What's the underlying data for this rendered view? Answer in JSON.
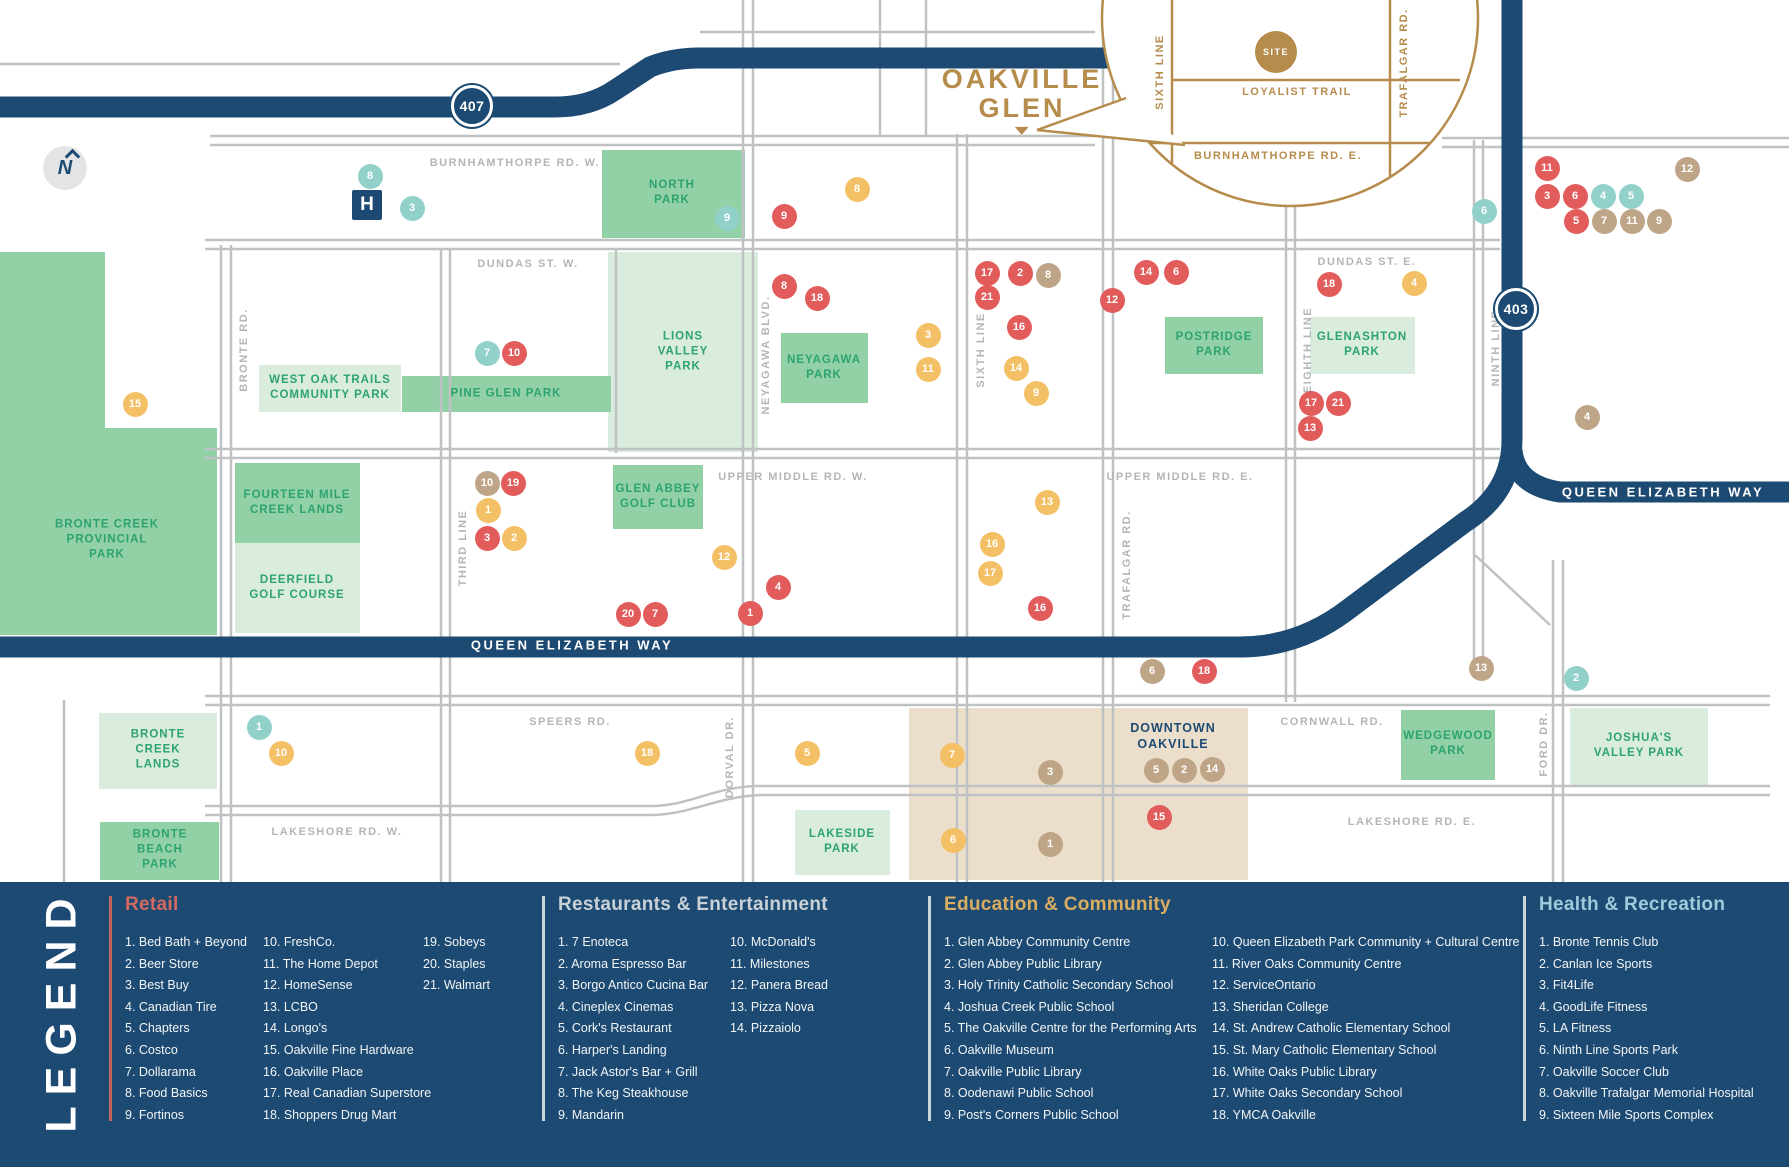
{
  "colors": {
    "navy": "#1d4a72",
    "gold": "#b68c4c",
    "road_gray": "#bfc1c3",
    "label_gray": "#b3b5b7",
    "park_medium": "#92d0a6",
    "park_light": "#d9ecdd",
    "park_text": "#2da371",
    "beige": "#ebdfcb",
    "retail": "#e25c5c",
    "restaurants": "#f4c065",
    "education": "#bfa587",
    "health": "#92d0ca"
  },
  "map": {
    "compass_letter": "N",
    "hospital_label": "H",
    "badges": [
      {
        "label": "407",
        "x": 472,
        "y": 106
      },
      {
        "label": "403",
        "x": 1516,
        "y": 309
      }
    ],
    "qew_labels": [
      {
        "text": "QUEEN ELIZABETH WAY",
        "x": 572,
        "y": 645
      },
      {
        "text": "QUEEN ELIZABETH WAY",
        "x": 1663,
        "y": 492
      }
    ],
    "callout": {
      "title_line1": "OAKVILLE",
      "title_line2": "GLEN",
      "site_label": "SITE",
      "labels": [
        {
          "text": "SIXTH LINE",
          "x": 1160,
          "y": 72,
          "orient": "v"
        },
        {
          "text": "TRAFALGAR RD.",
          "x": 1404,
          "y": 63,
          "orient": "v"
        },
        {
          "text": "LOYALIST TRAIL",
          "x": 1297,
          "y": 92,
          "orient": "h"
        },
        {
          "text": "BURNHAMTHORPE RD. E.",
          "x": 1278,
          "y": 156,
          "orient": "h"
        }
      ]
    },
    "road_labels": [
      {
        "text": "BURNHAMTHORPE RD. W.",
        "x": 515,
        "y": 163,
        "orient": "h"
      },
      {
        "text": "DUNDAS ST. W.",
        "x": 528,
        "y": 264,
        "orient": "h"
      },
      {
        "text": "DUNDAS ST. E.",
        "x": 1367,
        "y": 262,
        "orient": "h"
      },
      {
        "text": "UPPER MIDDLE RD. W.",
        "x": 793,
        "y": 477,
        "orient": "h"
      },
      {
        "text": "UPPER MIDDLE RD. E.",
        "x": 1180,
        "y": 477,
        "orient": "h"
      },
      {
        "text": "SPEERS RD.",
        "x": 570,
        "y": 722,
        "orient": "h"
      },
      {
        "text": "CORNWALL RD.",
        "x": 1332,
        "y": 722,
        "orient": "h"
      },
      {
        "text": "LAKESHORE RD. W.",
        "x": 337,
        "y": 832,
        "orient": "h"
      },
      {
        "text": "LAKESHORE RD. E.",
        "x": 1412,
        "y": 822,
        "orient": "h"
      },
      {
        "text": "BRONTE RD.",
        "x": 244,
        "y": 350,
        "orient": "v"
      },
      {
        "text": "THIRD LINE",
        "x": 463,
        "y": 548,
        "orient": "v"
      },
      {
        "text": "NEYAGAWA BLVD.",
        "x": 766,
        "y": 355,
        "orient": "v"
      },
      {
        "text": "SIXTH LINE",
        "x": 981,
        "y": 350,
        "orient": "v"
      },
      {
        "text": "TRAFALGAR RD.",
        "x": 1127,
        "y": 565,
        "orient": "v"
      },
      {
        "text": "EIGHTH LINE",
        "x": 1308,
        "y": 350,
        "orient": "v"
      },
      {
        "text": "NINTH LINE",
        "x": 1496,
        "y": 348,
        "orient": "v"
      },
      {
        "text": "DORVAL DR.",
        "x": 730,
        "y": 757,
        "orient": "v"
      },
      {
        "text": "FORD DR.",
        "x": 1544,
        "y": 744,
        "orient": "v"
      }
    ],
    "parks": [
      {
        "label": "BRONTE CREEK\nPROVINCIAL\nPARK",
        "x": 0,
        "y": 252,
        "w": 217,
        "h": 383,
        "tone": "medium",
        "lx": 107,
        "ly": 540
      },
      {
        "label": "",
        "x": 105,
        "y": 252,
        "w": 112,
        "h": 176,
        "tone": "notch",
        "lx": -100,
        "ly": -100
      },
      {
        "label": "NORTH\nPARK",
        "x": 602,
        "y": 150,
        "w": 143,
        "h": 88,
        "tone": "medium",
        "lx": 672,
        "ly": 193
      },
      {
        "label": "LIONS\nVALLEY\nPARK",
        "x": 608,
        "y": 252,
        "w": 150,
        "h": 200,
        "tone": "light",
        "lx": 683,
        "ly": 352
      },
      {
        "label": "PINE GLEN PARK",
        "x": 402,
        "y": 376,
        "w": 209,
        "h": 36,
        "tone": "medium",
        "lx": 506,
        "ly": 394
      },
      {
        "label": "GLEN ABBEY\nGOLF CLUB",
        "x": 613,
        "y": 465,
        "w": 90,
        "h": 64,
        "tone": "medium",
        "lx": 658,
        "ly": 497
      },
      {
        "label": "NEYAGAWA\nPARK",
        "x": 781,
        "y": 333,
        "w": 87,
        "h": 70,
        "tone": "medium",
        "lx": 824,
        "ly": 368
      },
      {
        "label": "WEST OAK TRAILS\nCOMMUNITY PARK",
        "x": 259,
        "y": 365,
        "w": 142,
        "h": 47,
        "tone": "light",
        "lx": 330,
        "ly": 388
      },
      {
        "label": "FOURTEEN MILE\nCREEK LANDS",
        "x": 235,
        "y": 463,
        "w": 125,
        "h": 80,
        "tone": "medium",
        "lx": 297,
        "ly": 503
      },
      {
        "label": "DEERFIELD\nGOLF COURSE",
        "x": 235,
        "y": 543,
        "w": 125,
        "h": 90,
        "tone": "light",
        "lx": 297,
        "ly": 588
      },
      {
        "label": "BRONTE\nCREEK\nLANDS",
        "x": 99,
        "y": 713,
        "w": 118,
        "h": 76,
        "tone": "light",
        "lx": 158,
        "ly": 750
      },
      {
        "label": "BRONTE\nBEACH\nPARK",
        "x": 100,
        "y": 822,
        "w": 119,
        "h": 58,
        "tone": "medium",
        "lx": 160,
        "ly": 850
      },
      {
        "label": "POSTRIDGE\nPARK",
        "x": 1165,
        "y": 317,
        "w": 98,
        "h": 57,
        "tone": "medium",
        "lx": 1214,
        "ly": 345
      },
      {
        "label": "GLENASHTON\nPARK",
        "x": 1310,
        "y": 317,
        "w": 105,
        "h": 57,
        "tone": "light",
        "lx": 1362,
        "ly": 345
      },
      {
        "label": "LAKESIDE\nPARK",
        "x": 795,
        "y": 810,
        "w": 95,
        "h": 65,
        "tone": "light",
        "lx": 842,
        "ly": 842
      },
      {
        "label": "WEDGEWOOD\nPARK",
        "x": 1401,
        "y": 710,
        "w": 94,
        "h": 70,
        "tone": "medium",
        "lx": 1448,
        "ly": 744
      },
      {
        "label": "JOSHUA'S\nVALLEY PARK",
        "x": 1570,
        "y": 708,
        "w": 138,
        "h": 78,
        "tone": "light",
        "lx": 1639,
        "ly": 746
      },
      {
        "label": "",
        "x": 909,
        "y": 708,
        "w": 339,
        "h": 172,
        "tone": "beige",
        "lx": -100,
        "ly": -100
      }
    ],
    "downtown_label": "DOWNTOWN\nOAKVILLE",
    "markers": [
      {
        "n": "8",
        "cat": "health",
        "x": 370,
        "y": 176
      },
      {
        "n": "3",
        "cat": "health",
        "x": 412,
        "y": 208
      },
      {
        "n": "9",
        "cat": "health",
        "x": 727,
        "y": 218
      },
      {
        "n": "7",
        "cat": "health",
        "x": 487,
        "y": 353
      },
      {
        "n": "6",
        "cat": "health",
        "x": 1484,
        "y": 211
      },
      {
        "n": "4",
        "cat": "health",
        "x": 1603,
        "y": 196
      },
      {
        "n": "5",
        "cat": "health",
        "x": 1631,
        "y": 196
      },
      {
        "n": "1",
        "cat": "health",
        "x": 259,
        "y": 727
      },
      {
        "n": "2",
        "cat": "health",
        "x": 1576,
        "y": 678
      },
      {
        "n": "9",
        "cat": "retail",
        "x": 784,
        "y": 216
      },
      {
        "n": "8",
        "cat": "retail",
        "x": 784,
        "y": 286
      },
      {
        "n": "18",
        "cat": "retail",
        "x": 817,
        "y": 298
      },
      {
        "n": "17",
        "cat": "retail",
        "x": 987,
        "y": 273
      },
      {
        "n": "2",
        "cat": "retail",
        "x": 1020,
        "y": 273
      },
      {
        "n": "21",
        "cat": "retail",
        "x": 987,
        "y": 297
      },
      {
        "n": "16",
        "cat": "retail",
        "x": 1019,
        "y": 327
      },
      {
        "n": "12",
        "cat": "retail",
        "x": 1112,
        "y": 300
      },
      {
        "n": "14",
        "cat": "retail",
        "x": 1146,
        "y": 272
      },
      {
        "n": "6",
        "cat": "retail",
        "x": 1176,
        "y": 272
      },
      {
        "n": "18",
        "cat": "retail",
        "x": 1329,
        "y": 284
      },
      {
        "n": "11",
        "cat": "retail",
        "x": 1547,
        "y": 168
      },
      {
        "n": "3",
        "cat": "retail",
        "x": 1547,
        "y": 196
      },
      {
        "n": "6",
        "cat": "retail",
        "x": 1575,
        "y": 196
      },
      {
        "n": "5",
        "cat": "retail",
        "x": 1576,
        "y": 221
      },
      {
        "n": "10",
        "cat": "retail",
        "x": 514,
        "y": 353
      },
      {
        "n": "19",
        "cat": "retail",
        "x": 513,
        "y": 483
      },
      {
        "n": "3",
        "cat": "retail",
        "x": 487,
        "y": 538
      },
      {
        "n": "4",
        "cat": "retail",
        "x": 778,
        "y": 587
      },
      {
        "n": "1",
        "cat": "retail",
        "x": 750,
        "y": 613
      },
      {
        "n": "20",
        "cat": "retail",
        "x": 628,
        "y": 614
      },
      {
        "n": "7",
        "cat": "retail",
        "x": 655,
        "y": 614
      },
      {
        "n": "16",
        "cat": "retail",
        "x": 1040,
        "y": 608
      },
      {
        "n": "17",
        "cat": "retail",
        "x": 1311,
        "y": 403
      },
      {
        "n": "21",
        "cat": "retail",
        "x": 1338,
        "y": 403
      },
      {
        "n": "13",
        "cat": "retail",
        "x": 1310,
        "y": 428
      },
      {
        "n": "18",
        "cat": "retail",
        "x": 1204,
        "y": 671
      },
      {
        "n": "15",
        "cat": "retail",
        "x": 1159,
        "y": 817
      },
      {
        "n": "8",
        "cat": "restaurants",
        "x": 857,
        "y": 189
      },
      {
        "n": "3",
        "cat": "restaurants",
        "x": 928,
        "y": 335
      },
      {
        "n": "11",
        "cat": "restaurants",
        "x": 928,
        "y": 369
      },
      {
        "n": "14",
        "cat": "restaurants",
        "x": 1016,
        "y": 368
      },
      {
        "n": "9",
        "cat": "restaurants",
        "x": 1036,
        "y": 393
      },
      {
        "n": "4",
        "cat": "restaurants",
        "x": 1414,
        "y": 283
      },
      {
        "n": "13",
        "cat": "restaurants",
        "x": 1047,
        "y": 502
      },
      {
        "n": "16",
        "cat": "restaurants",
        "x": 992,
        "y": 544
      },
      {
        "n": "17",
        "cat": "restaurants",
        "x": 990,
        "y": 573
      },
      {
        "n": "12",
        "cat": "restaurants",
        "x": 724,
        "y": 557
      },
      {
        "n": "1",
        "cat": "restaurants",
        "x": 488,
        "y": 510
      },
      {
        "n": "2",
        "cat": "restaurants",
        "x": 514,
        "y": 538
      },
      {
        "n": "15",
        "cat": "restaurants",
        "x": 135,
        "y": 404
      },
      {
        "n": "10",
        "cat": "restaurants",
        "x": 281,
        "y": 753
      },
      {
        "n": "18",
        "cat": "restaurants",
        "x": 647,
        "y": 753
      },
      {
        "n": "5",
        "cat": "restaurants",
        "x": 807,
        "y": 753
      },
      {
        "n": "7",
        "cat": "restaurants",
        "x": 952,
        "y": 755
      },
      {
        "n": "6",
        "cat": "restaurants",
        "x": 953,
        "y": 840
      },
      {
        "n": "8",
        "cat": "education",
        "x": 1048,
        "y": 275
      },
      {
        "n": "12",
        "cat": "education",
        "x": 1687,
        "y": 169
      },
      {
        "n": "7",
        "cat": "education",
        "x": 1604,
        "y": 221
      },
      {
        "n": "11",
        "cat": "education",
        "x": 1632,
        "y": 221
      },
      {
        "n": "9",
        "cat": "education",
        "x": 1659,
        "y": 221
      },
      {
        "n": "10",
        "cat": "education",
        "x": 487,
        "y": 483
      },
      {
        "n": "4",
        "cat": "education",
        "x": 1587,
        "y": 417
      },
      {
        "n": "6",
        "cat": "education",
        "x": 1152,
        "y": 671
      },
      {
        "n": "13",
        "cat": "education",
        "x": 1481,
        "y": 668
      },
      {
        "n": "3",
        "cat": "education",
        "x": 1050,
        "y": 772
      },
      {
        "n": "5",
        "cat": "education",
        "x": 1156,
        "y": 770
      },
      {
        "n": "2",
        "cat": "education",
        "x": 1184,
        "y": 770
      },
      {
        "n": "14",
        "cat": "education",
        "x": 1212,
        "y": 769
      },
      {
        "n": "1",
        "cat": "education",
        "x": 1050,
        "y": 844
      }
    ]
  },
  "legend": {
    "title": "LEGEND",
    "sections": [
      {
        "heading": "Retail",
        "heading_color": "#d4695f",
        "rule_color": "#c3655e",
        "rule_x": 109,
        "columns": [
          {
            "x": 125,
            "items": [
              "1. Bed Bath + Beyond",
              "2. Beer Store",
              "3. Best Buy",
              "4. Canadian Tire",
              "5. Chapters",
              "6. Costco",
              "7. Dollarama",
              "8. Food Basics",
              "9. Fortinos"
            ]
          },
          {
            "x": 263,
            "items": [
              "10. FreshCo.",
              "11. The Home Depot",
              "12. HomeSense",
              "13. LCBO",
              "14. Longo's",
              "15. Oakville Fine Hardware",
              "16. Oakville Place",
              "17. Real Canadian Superstore",
              "18. Shoppers Drug Mart"
            ]
          },
          {
            "x": 423,
            "items": [
              "19. Sobeys",
              "20. Staples",
              "21. Walmart"
            ]
          }
        ]
      },
      {
        "heading": "Restaurants & Entertainment",
        "heading_color": "#c9d1d8",
        "rule_color": "#ccd6dd",
        "rule_x": 542,
        "columns": [
          {
            "x": 558,
            "items": [
              "1. 7 Enoteca",
              "2. Aroma Espresso Bar",
              "3. Borgo Antico Cucina Bar",
              "4. Cineplex Cinemas",
              "5. Cork's Restaurant",
              "6. Harper's Landing",
              "7. Jack Astor's Bar + Grill",
              "8. The Keg Steakhouse",
              "9. Mandarin"
            ]
          },
          {
            "x": 730,
            "items": [
              "10. McDonald's",
              "11. Milestones",
              "12. Panera Bread",
              "13. Pizza Nova",
              "14. Pizzaiolo"
            ]
          }
        ]
      },
      {
        "heading": "Education & Community",
        "heading_color": "#d9ad62",
        "rule_color": "#ccd6dd",
        "rule_x": 928,
        "columns": [
          {
            "x": 944,
            "items": [
              "1. Glen Abbey Community Centre",
              "2. Glen Abbey Public Library",
              "3. Holy Trinity Catholic Secondary School",
              "4. Joshua Creek Public School",
              "5. The Oakville Centre for the Performing Arts",
              "6. Oakville Museum",
              "7. Oakville Public Library",
              "8. Oodenawi Public School",
              "9. Post's Corners Public School"
            ]
          },
          {
            "x": 1212,
            "items": [
              "10. Queen Elizabeth Park Community + Cultural Centre",
              "11. River Oaks Community Centre",
              "12. ServiceOntario",
              "13. Sheridan College",
              "14. St. Andrew Catholic Elementary School",
              "15. St. Mary Catholic Elementary School",
              "16. White Oaks Public Library",
              "17. White Oaks Secondary School",
              "18. YMCA Oakville"
            ]
          }
        ]
      },
      {
        "heading": "Health & Recreation",
        "heading_color": "#9ecadb",
        "rule_color": "#ccd6dd",
        "rule_x": 1523,
        "columns": [
          {
            "x": 1539,
            "items": [
              "1. Bronte Tennis Club",
              "2. Canlan Ice Sports",
              "3. Fit4Life",
              "4. GoodLife Fitness",
              "5. LA Fitness",
              "6. Ninth Line Sports Park",
              "7. Oakville Soccer Club",
              "8. Oakville Trafalgar Memorial Hospital",
              "9. Sixteen Mile Sports Complex"
            ]
          }
        ]
      }
    ]
  }
}
